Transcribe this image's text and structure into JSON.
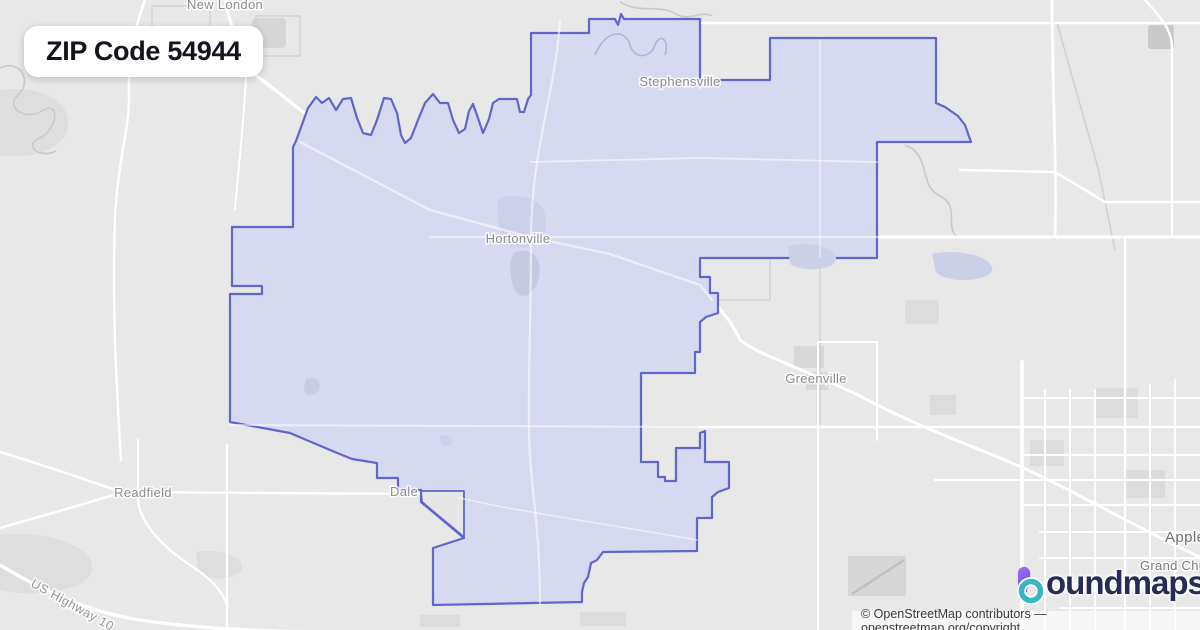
{
  "title_card": {
    "text": "ZIP Code 54944"
  },
  "map": {
    "labels": [
      {
        "text": "New London"
      },
      {
        "text": "Stephensville"
      },
      {
        "text": "Hortonville"
      },
      {
        "text": "Greenville"
      },
      {
        "text": "Readfield"
      },
      {
        "text": "Dale"
      },
      {
        "text": "Appleton"
      },
      {
        "text": "Grand Chute"
      }
    ],
    "rotated_road_label": {
      "text": "US Highway 10"
    },
    "colors": {
      "boundary_stroke": "#6165cc",
      "boundary_fill": "#d6d9f0",
      "map_background": "#e8e8e8",
      "road": "#ffffff"
    }
  },
  "watermark": {
    "brand": "boundmaps",
    "wordmark_rest": "oundmaps",
    "icon_purple": "#7c4dee",
    "icon_teal": "#38b6c6",
    "wordmark_color": "#272c55"
  },
  "attribution": {
    "text": "© OpenStreetMap contributors — openstreetmap.org/copyright"
  }
}
